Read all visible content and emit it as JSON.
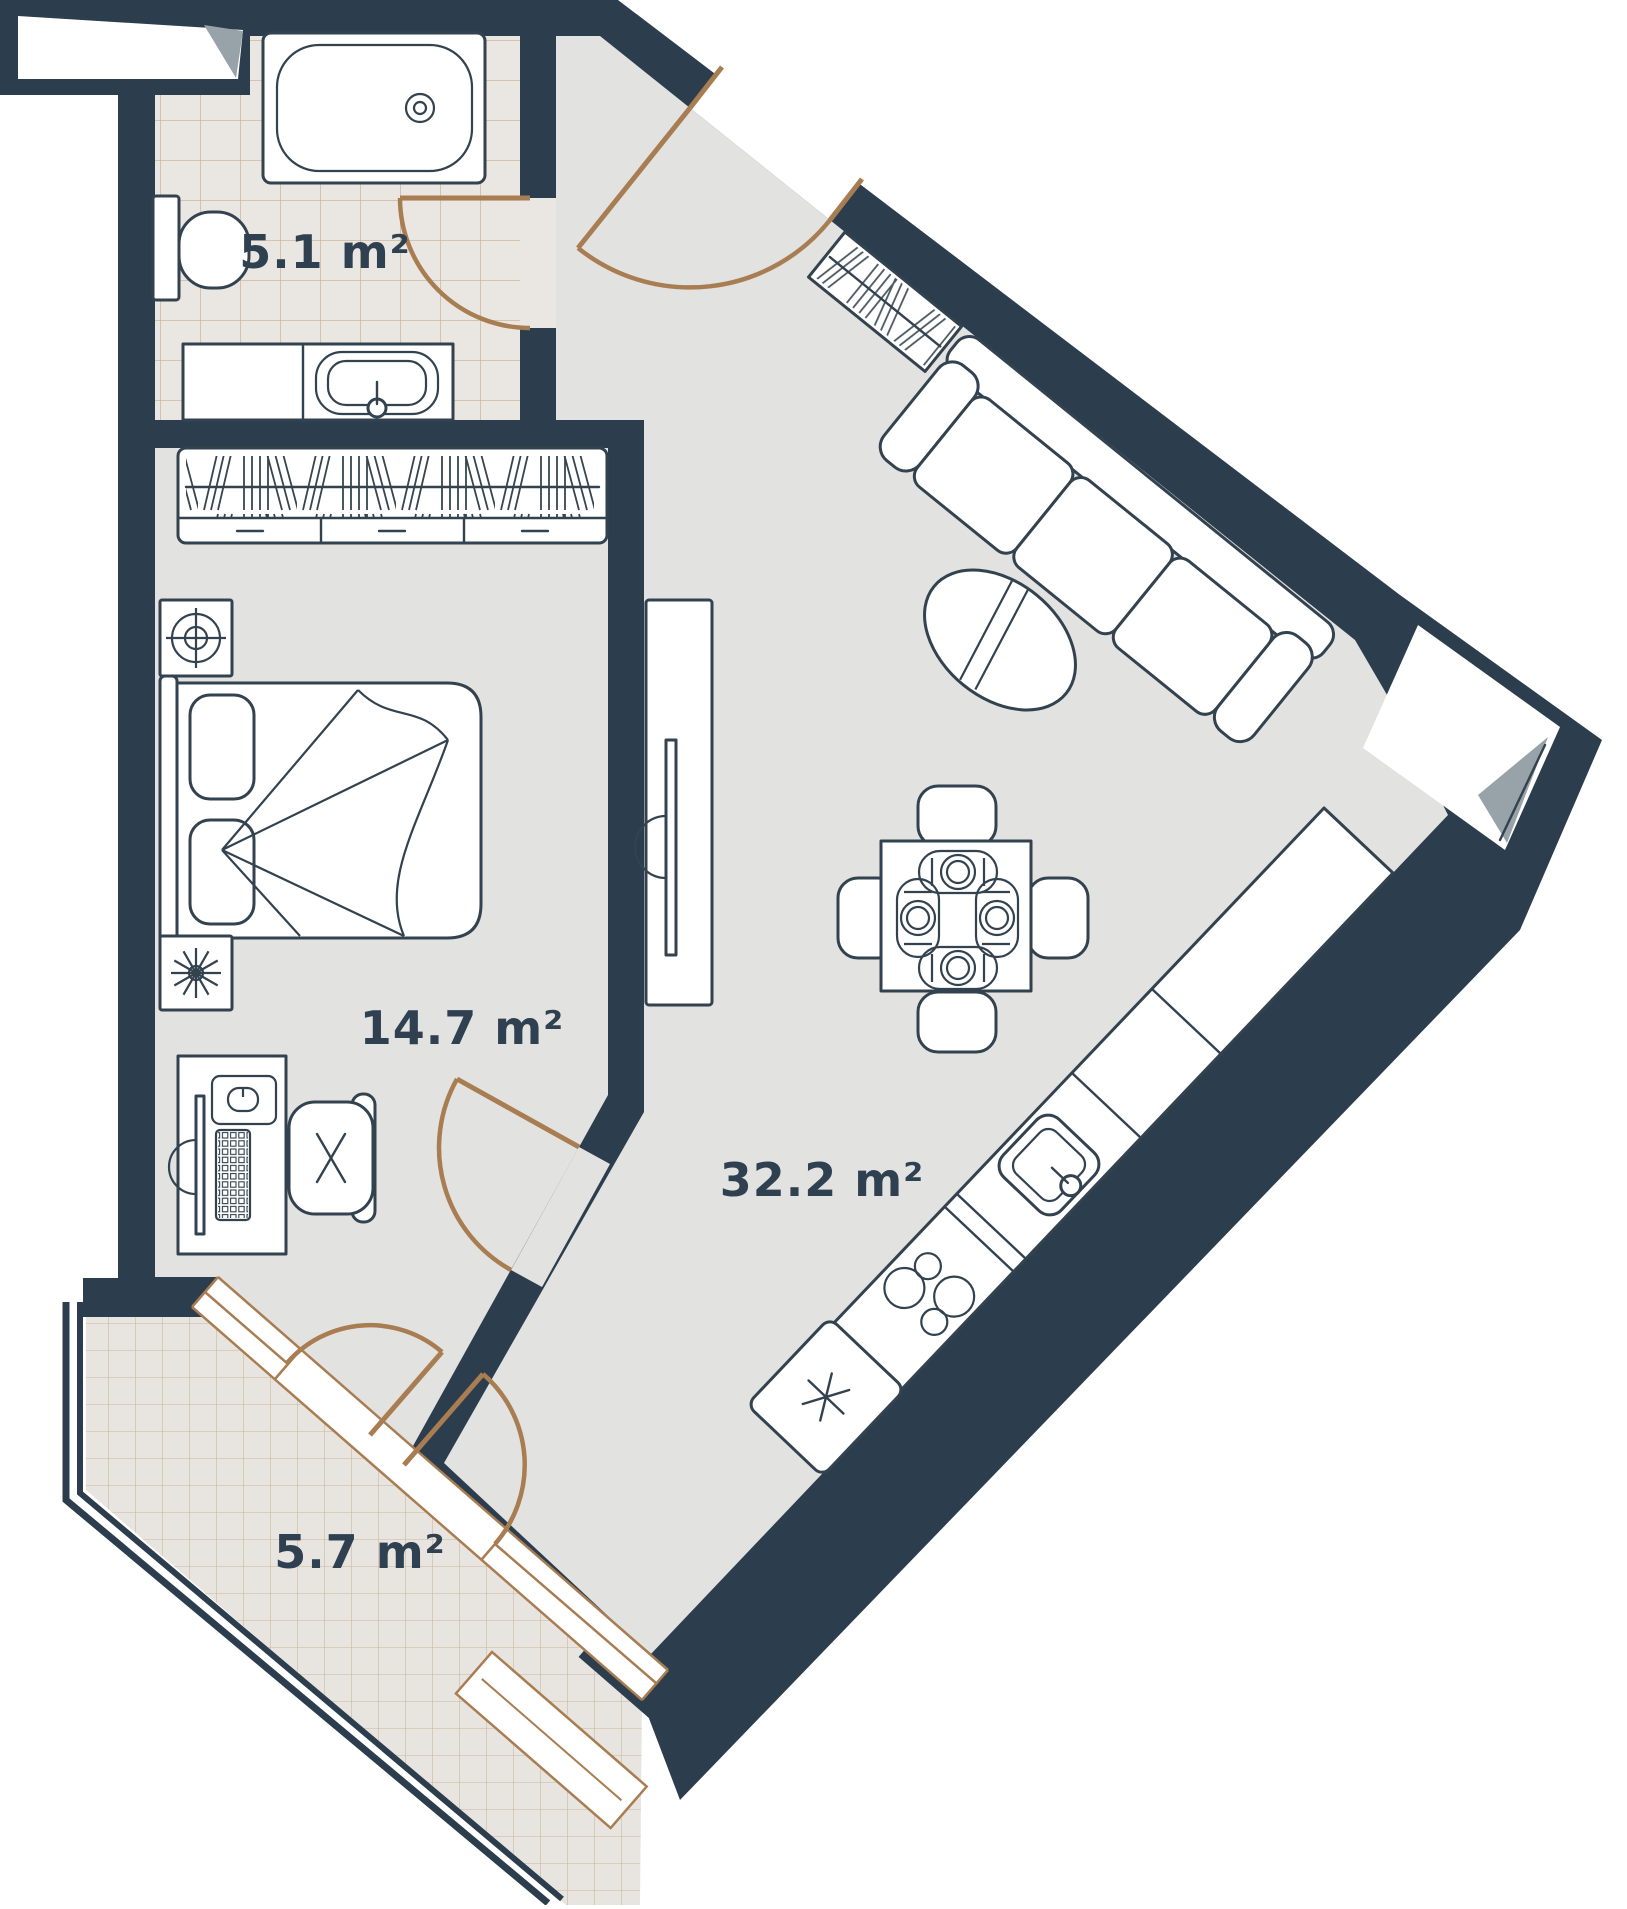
{
  "plan": {
    "background": "#ffffff",
    "colors": {
      "wall": "#2c3e4e",
      "floor": "#e2e2e1",
      "bath_tile_bg": "#eae7e2",
      "balcony_tile_bg": "#e8e5e0",
      "tile_line": "#bb9c72",
      "door": "#a97d52",
      "furniture_outline": "#33424f",
      "shade": "#98a2a9",
      "label": "#2f4050"
    },
    "rooms": [
      {
        "name": "bathroom",
        "area_label": "5.1 m²"
      },
      {
        "name": "bedroom",
        "area_label": "14.7 m²"
      },
      {
        "name": "living-kitchen",
        "area_label": "32.2 m²"
      },
      {
        "name": "balcony",
        "area_label": "5.7 m²"
      }
    ],
    "furniture_icons": [
      "bathtub",
      "toilet",
      "vanity-sink",
      "wardrobe",
      "entry-closet",
      "double-bed",
      "nightstand-lamp",
      "nightstand-plant",
      "desk",
      "desk-chair",
      "tv-stand",
      "sofa",
      "coffee-table",
      "dining-table",
      "dining-chairs",
      "place-settings",
      "kitchen-sink",
      "stove",
      "fridge",
      "balcony-glazing",
      "door-swing"
    ]
  }
}
